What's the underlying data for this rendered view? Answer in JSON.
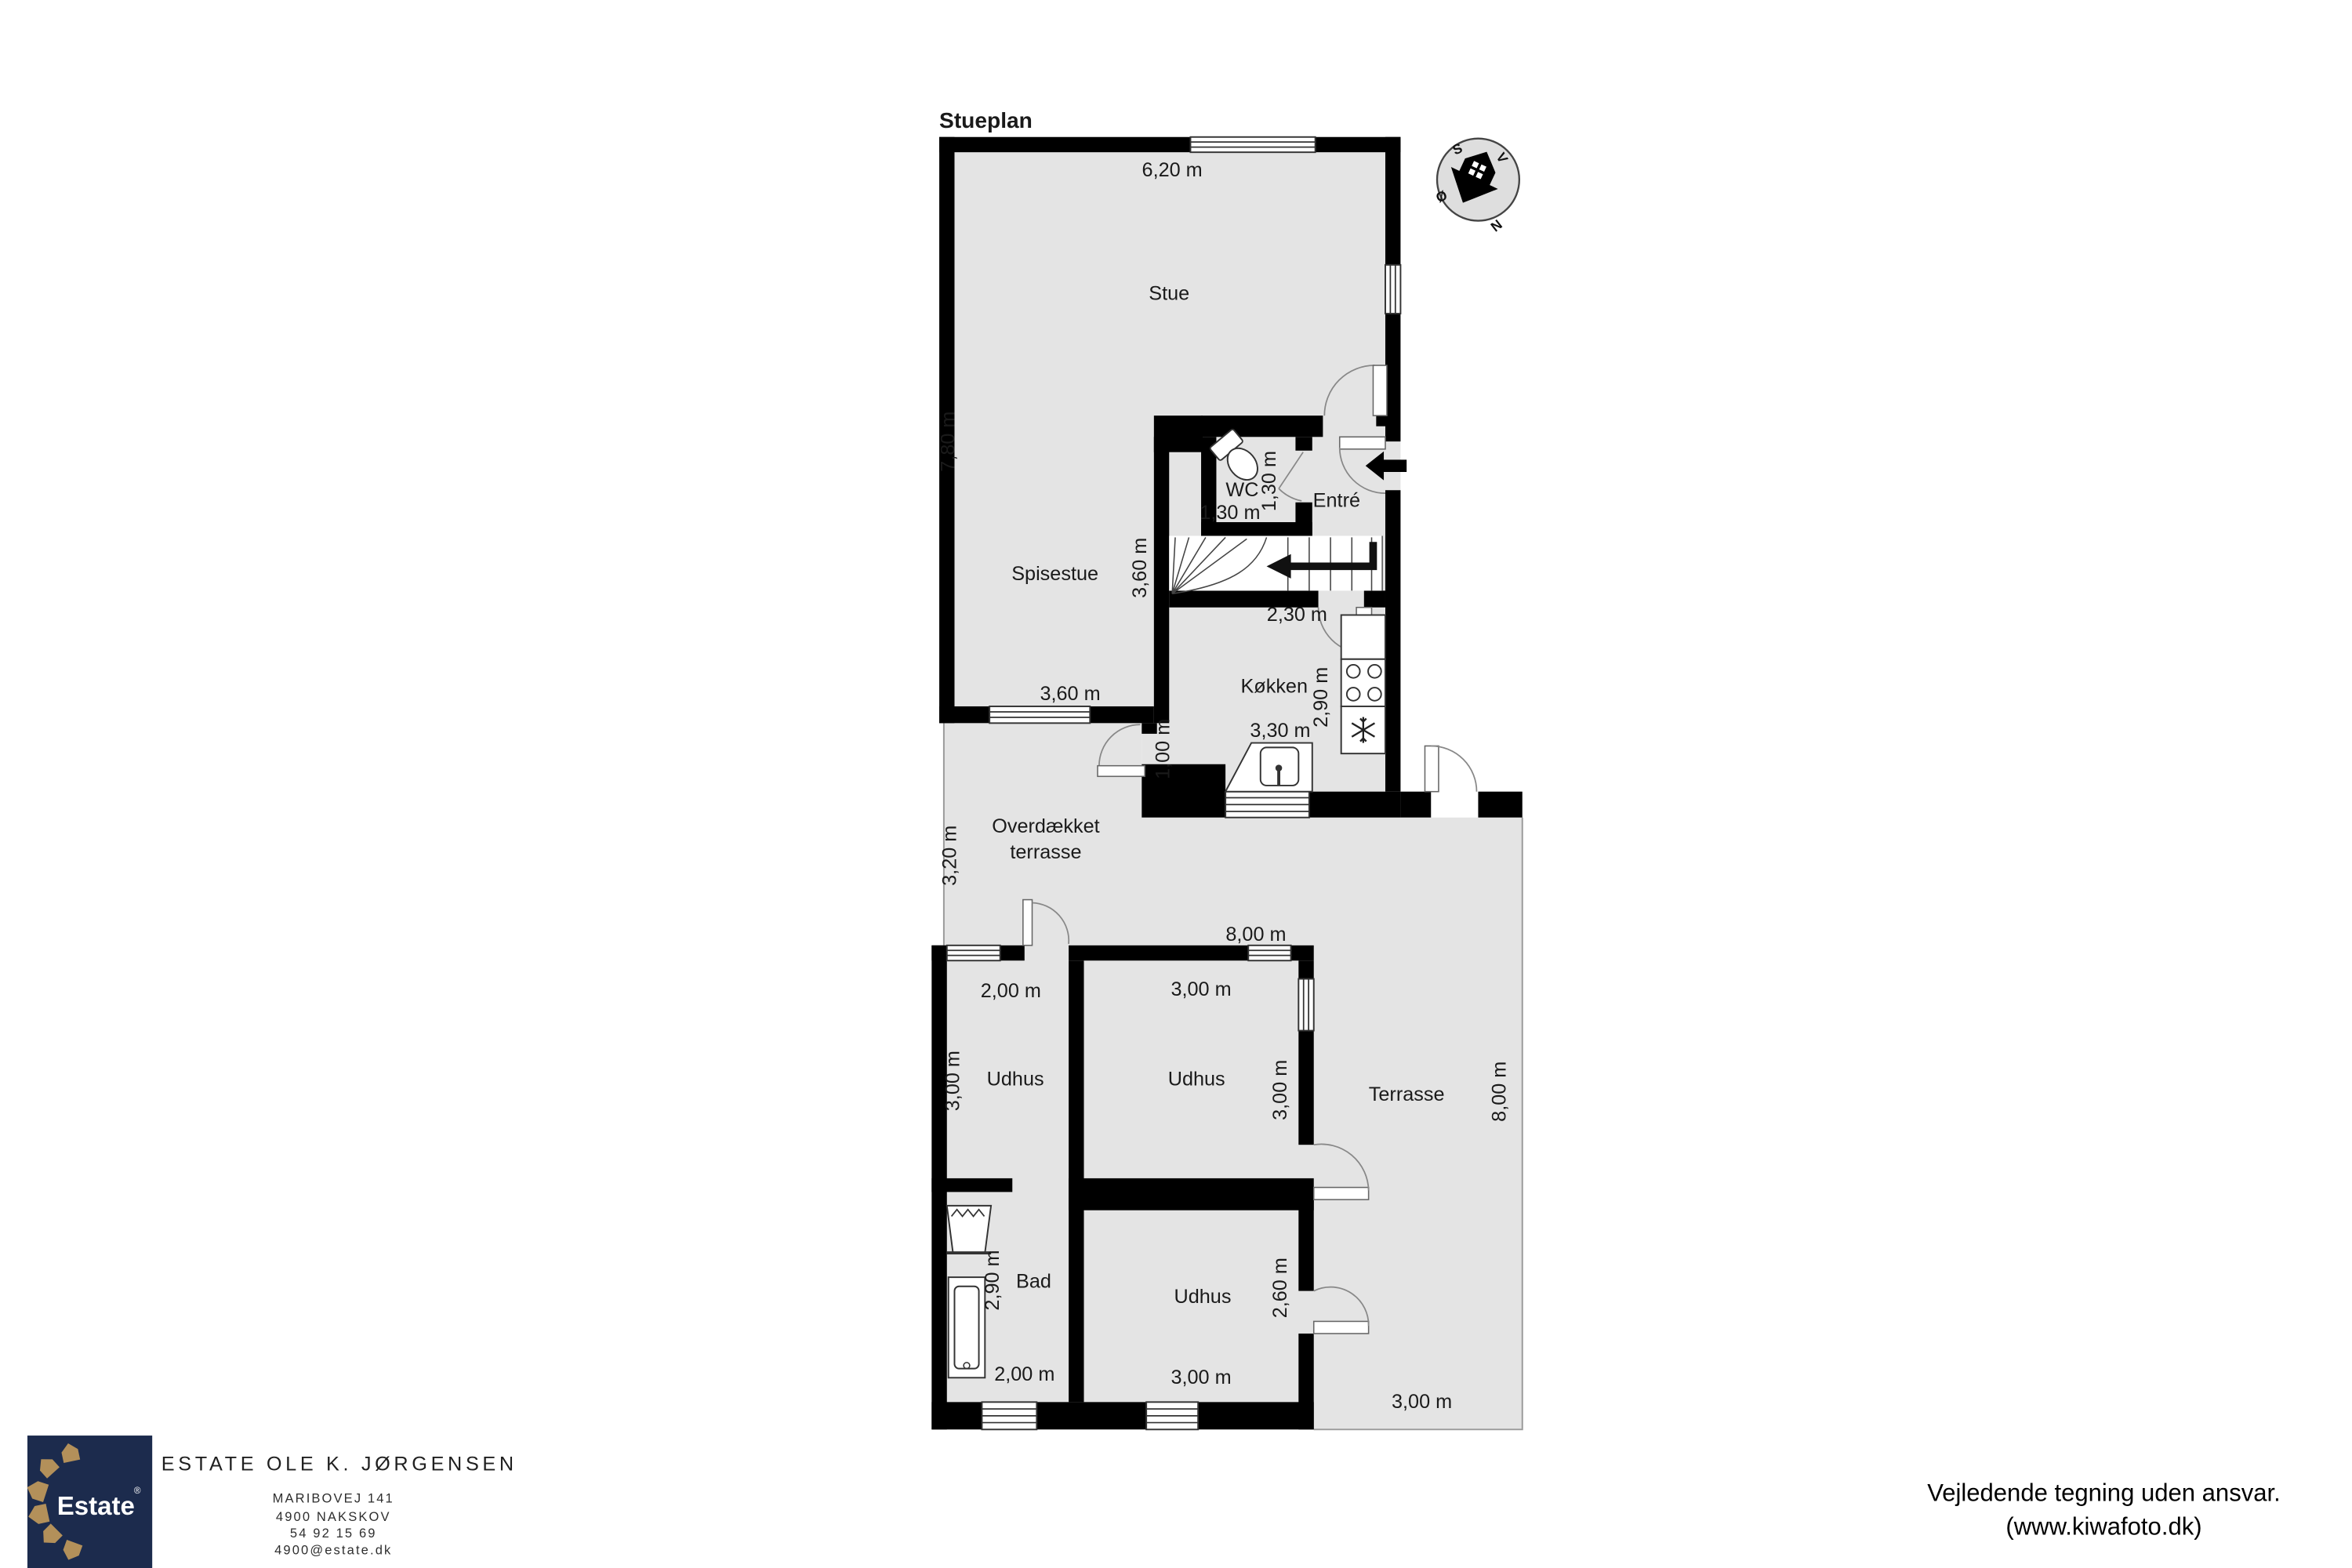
{
  "plan": {
    "title": "Stueplan",
    "rooms": {
      "stue": "Stue",
      "spisestue": "Spisestue",
      "wc": "WC",
      "entre": "Entré",
      "kitchen": "Køkken",
      "covered_terrace_line1": "Overdækket",
      "covered_terrace_line2": "terrasse",
      "outbuilding": "Udhus",
      "terrace": "Terrasse",
      "bath": "Bad"
    },
    "dimensions": {
      "stue_width": "6,20 m",
      "stue_depth": "7,80 m",
      "wc_width": "1,30 m",
      "wc_depth": "1,30 m",
      "stair_width": "2,30 m",
      "spisestue_depth": "3,60 m",
      "spisestue_width": "3,60 m",
      "kitchen_depth": "2,90 m",
      "kitchen_width": "3,30 m",
      "passage_height": "1,00 m",
      "covered_terrace_depth": "3,20 m",
      "outbuilding_total_width": "8,00 m",
      "outbuilding1_width": "2,00 m",
      "outbuilding1_depth": "3,00 m",
      "outbuilding2_width": "3,00 m",
      "outbuilding2_depth": "3,00 m",
      "terrace_depth": "8,00 m",
      "bath_depth": "2,90 m",
      "bath_width": "2,00 m",
      "outbuilding3_width": "3,00 m",
      "outbuilding3_depth": "2,60 m",
      "terrace_width": "3,00 m"
    },
    "compass": {
      "north": "N",
      "south": "S",
      "east": "Ø",
      "west": "V"
    },
    "colors": {
      "wall": "#000000",
      "floor": "#e4e4e4"
    }
  },
  "footer": {
    "logo": {
      "text": "Estate",
      "registered": "®",
      "background": "#1c2b4d",
      "gold": "#b3905a"
    },
    "company": "ESTATE OLE K. JØRGENSEN",
    "address_line1": "MARIBOVEJ 141",
    "address_line2": "4900 NAKSKOV",
    "phone": "54 92 15 69",
    "email": "4900@estate.dk"
  },
  "disclaimer": {
    "line1": "Vejledende tegning uden ansvar.",
    "line2": "(www.kiwafoto.dk)"
  }
}
